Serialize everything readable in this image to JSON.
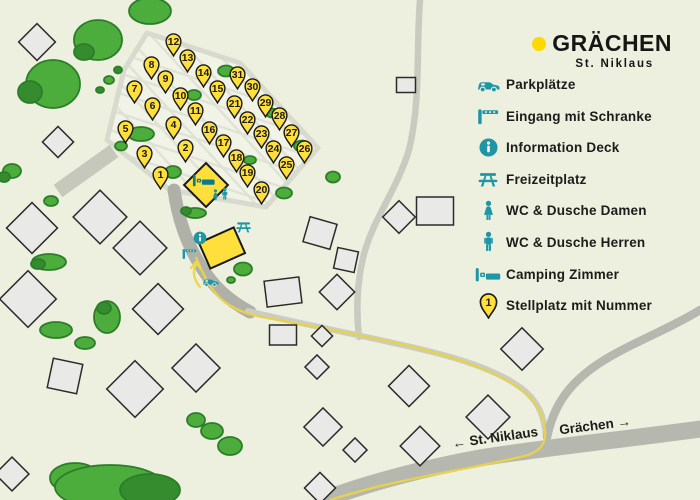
{
  "logo": {
    "name": "GRÄCHEN",
    "subtitle": "St. Niklaus"
  },
  "legend": {
    "pin_sample_number": "1",
    "items": [
      {
        "icon": "car-icon",
        "label": "Parkplätze"
      },
      {
        "icon": "barrier-icon",
        "label": "Eingang mit Schranke"
      },
      {
        "icon": "info-icon",
        "label": "Information Deck"
      },
      {
        "icon": "picnic-icon",
        "label": "Freizeitplatz"
      },
      {
        "icon": "wc-women-icon",
        "label": "WC & Dusche Damen"
      },
      {
        "icon": "wc-men-icon",
        "label": "WC & Dusche Herren"
      },
      {
        "icon": "bed-icon",
        "label": "Camping Zimmer"
      },
      {
        "icon": "pin-icon",
        "label": "Stellplatz mit Nummer"
      }
    ]
  },
  "road_labels": {
    "st_niklaus": "← St. Niklaus",
    "graechen": "Grächen →"
  },
  "map": {
    "colors": {
      "pin_fill": "#FFDF3C",
      "teal": "#1F96A5",
      "route": "#E7D24B"
    },
    "pins": [
      {
        "n": 1,
        "x": 160,
        "y": 174
      },
      {
        "n": 2,
        "x": 185,
        "y": 147
      },
      {
        "n": 3,
        "x": 144,
        "y": 153
      },
      {
        "n": 4,
        "x": 173,
        "y": 124
      },
      {
        "n": 5,
        "x": 125,
        "y": 128
      },
      {
        "n": 6,
        "x": 152,
        "y": 105
      },
      {
        "n": 7,
        "x": 134,
        "y": 88
      },
      {
        "n": 8,
        "x": 151,
        "y": 64
      },
      {
        "n": 9,
        "x": 165,
        "y": 78
      },
      {
        "n": 10,
        "x": 180,
        "y": 95
      },
      {
        "n": 11,
        "x": 195,
        "y": 110
      },
      {
        "n": 12,
        "x": 173,
        "y": 41
      },
      {
        "n": 13,
        "x": 187,
        "y": 57
      },
      {
        "n": 14,
        "x": 203,
        "y": 72
      },
      {
        "n": 15,
        "x": 217,
        "y": 88
      },
      {
        "n": 16,
        "x": 209,
        "y": 129
      },
      {
        "n": 17,
        "x": 223,
        "y": 142
      },
      {
        "n": 18,
        "x": 236,
        "y": 157
      },
      {
        "n": 19,
        "x": 247,
        "y": 172
      },
      {
        "n": 20,
        "x": 261,
        "y": 189
      },
      {
        "n": 21,
        "x": 234,
        "y": 103
      },
      {
        "n": 22,
        "x": 247,
        "y": 119
      },
      {
        "n": 23,
        "x": 261,
        "y": 133
      },
      {
        "n": 24,
        "x": 273,
        "y": 148
      },
      {
        "n": 25,
        "x": 286,
        "y": 164
      },
      {
        "n": 26,
        "x": 304,
        "y": 148
      },
      {
        "n": 27,
        "x": 291,
        "y": 132
      },
      {
        "n": 28,
        "x": 279,
        "y": 115
      },
      {
        "n": 29,
        "x": 265,
        "y": 102
      },
      {
        "n": 30,
        "x": 252,
        "y": 86
      },
      {
        "n": 31,
        "x": 237,
        "y": 74
      }
    ]
  }
}
